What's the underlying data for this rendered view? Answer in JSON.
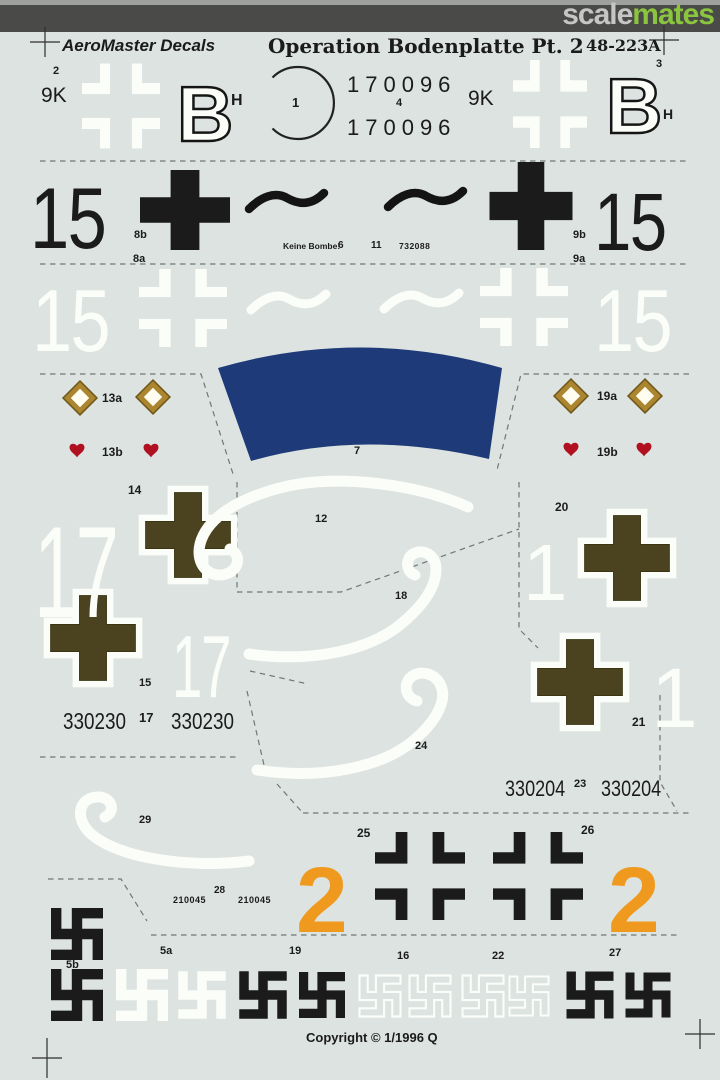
{
  "banner": {
    "logo_scale": "scale",
    "logo_mates": "mates"
  },
  "header": {
    "brand": "AeroMaster Decals",
    "title": "Operation Bodenplatte Pt. 2",
    "sheet_number": "48-223A"
  },
  "row1": {
    "label_2": "2",
    "code_left": "9K",
    "letter_left": "B",
    "h_left": "H",
    "circle_label": "1",
    "serial_top": "170096",
    "label_4": "4",
    "serial_bottom": "170096",
    "code_right": "9K",
    "letter_right": "B",
    "label_3": "3",
    "h_right": "H"
  },
  "row2": {
    "num_left": "15",
    "label_8b": "8b",
    "label_8a": "8a",
    "stencil": "Keine Bombe!",
    "label_6": "6",
    "label_11": "11",
    "serial": "732088",
    "label_9b": "9b",
    "label_9a": "9a",
    "num_right": "15"
  },
  "row3": {
    "num_left": "15",
    "num_right": "15"
  },
  "band": {
    "label_7": "7"
  },
  "emblems": {
    "label_13a": "13a",
    "label_13b": "13b",
    "label_19a": "19a",
    "label_19b": "19b"
  },
  "midleft": {
    "label_14": "14",
    "num_17_large": "17",
    "label_15": "15",
    "num_17_small": "17",
    "serial_a": "330230",
    "label_17": "17",
    "serial_b": "330230"
  },
  "midright": {
    "label_20": "20",
    "num_1_left": "1",
    "num_1_right": "1",
    "label_21": "21",
    "serial_a": "330204",
    "label_23": "23",
    "serial_b": "330204"
  },
  "swirls": {
    "label_12": "12",
    "label_18": "18",
    "label_24": "24",
    "label_29": "29"
  },
  "lower": {
    "label_25": "25",
    "label_26": "26",
    "num_2_left": "2",
    "num_2_right": "2",
    "label_28": "28",
    "serial_a": "210045",
    "serial_b": "210045"
  },
  "bottom": {
    "label_5b": "5b",
    "label_5a": "5a",
    "label_19": "19",
    "label_16": "16",
    "label_22": "22",
    "label_27": "27"
  },
  "footer": {
    "copyright": "Copyright © 1/1996 Q"
  },
  "colors": {
    "background": "#dce3e0",
    "banner_bg": "#4a4a48",
    "logo_gray": "#c6c6c6",
    "logo_green": "#8bc53f",
    "ink": "#1b1b1b",
    "decal_white": "#fbfdf9",
    "blue_band": "#1e3a78",
    "olive": "#4b431f",
    "orange": "#ef9a1e",
    "gold": "#ab852f",
    "gold_dark": "#6e5717",
    "heart_red": "#b01020",
    "dash": "#6f7876"
  }
}
